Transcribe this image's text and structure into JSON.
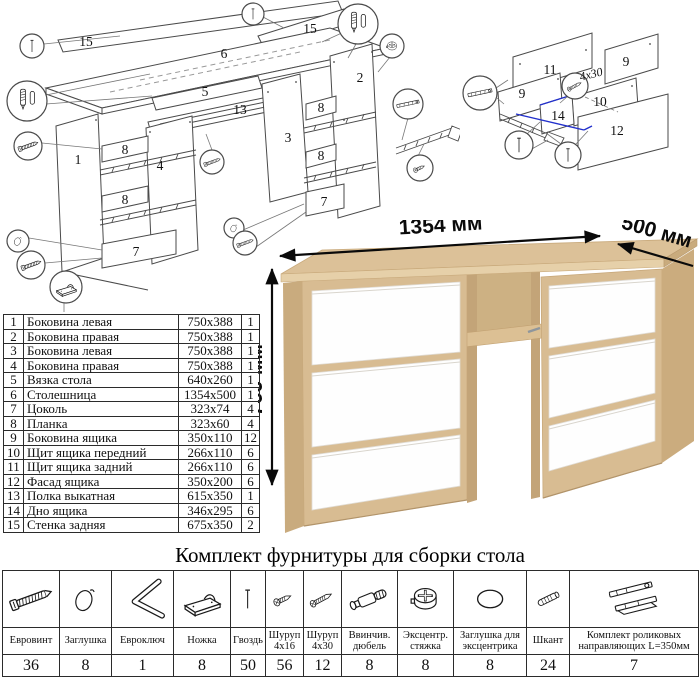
{
  "diagram": {
    "main_labels": {
      "p1": "1",
      "p2": "2",
      "p3": "3",
      "p4": "4",
      "p5": "5",
      "p6": "6",
      "p7": "7",
      "p8": "8",
      "p13": "13",
      "p15": "15"
    },
    "drawer_labels": {
      "p9": "9",
      "p10": "10",
      "p11": "11",
      "p12": "12",
      "p14": "14"
    },
    "screw_note": "4x30"
  },
  "parts_table": {
    "rows": [
      {
        "num": "1",
        "name": "Боковина левая",
        "size": "750x388",
        "qty": "1"
      },
      {
        "num": "2",
        "name": "Боковина правая",
        "size": "750x388",
        "qty": "1"
      },
      {
        "num": "3",
        "name": "Боковина левая",
        "size": "750x388",
        "qty": "1"
      },
      {
        "num": "4",
        "name": "Боковина правая",
        "size": "750x388",
        "qty": "1"
      },
      {
        "num": "5",
        "name": "Вязка стола",
        "size": "640x260",
        "qty": "1"
      },
      {
        "num": "6",
        "name": "Столешница",
        "size": "1354x500",
        "qty": "1"
      },
      {
        "num": "7",
        "name": "Цоколь",
        "size": "323x74",
        "qty": "4"
      },
      {
        "num": "8",
        "name": "Планка",
        "size": "323x60",
        "qty": "4"
      },
      {
        "num": "9",
        "name": "Боковина ящика",
        "size": "350x110",
        "qty": "12"
      },
      {
        "num": "10",
        "name": "Щит ящика передний",
        "size": "266x110",
        "qty": "6"
      },
      {
        "num": "11",
        "name": "Щит ящика задний",
        "size": "266x110",
        "qty": "6"
      },
      {
        "num": "12",
        "name": "Фасад ящика",
        "size": "350x200",
        "qty": "6"
      },
      {
        "num": "13",
        "name": "Полка выкатная",
        "size": "615x350",
        "qty": "1"
      },
      {
        "num": "14",
        "name": "Дно ящика",
        "size": "346x295",
        "qty": "6"
      },
      {
        "num": "15",
        "name": "Стенка задняя",
        "size": "675x350",
        "qty": "2"
      }
    ]
  },
  "desk": {
    "width_label": "1354 мм",
    "depth_label": "500 мм",
    "height_label": "766 мм",
    "body_color": "#d8bc92",
    "drawer_color": "#ffffff"
  },
  "hardware_kit": {
    "title": "Комплект фурнитуры для сборки стола",
    "items": [
      {
        "name": "Евровинт",
        "qty": "36",
        "icon": "euroscrew-icon"
      },
      {
        "name": "Заглушка",
        "qty": "8",
        "icon": "plug-icon"
      },
      {
        "name": "Евроключ",
        "qty": "1",
        "icon": "hex-key-icon"
      },
      {
        "name": "Ножка",
        "qty": "8",
        "icon": "foot-icon"
      },
      {
        "name": "Гвоздь",
        "qty": "50",
        "icon": "nail-icon"
      },
      {
        "name": "Шуруп 4x16",
        "qty": "56",
        "icon": "screw-short-icon"
      },
      {
        "name": "Шуруп 4x30",
        "qty": "12",
        "icon": "screw-long-icon"
      },
      {
        "name": "Ввинчив. дюбель",
        "qty": "8",
        "icon": "screw-dowel-icon"
      },
      {
        "name": "Эксцентр. стяжка",
        "qty": "8",
        "icon": "cam-lock-icon"
      },
      {
        "name": "Заглушка для эксцентрика",
        "qty": "8",
        "icon": "cam-cover-icon"
      },
      {
        "name": "Шкант",
        "qty": "24",
        "icon": "wood-dowel-icon"
      },
      {
        "name": "Комплект роликовых направляющих L=350мм",
        "qty": "7",
        "icon": "slide-rail-icon"
      }
    ]
  }
}
